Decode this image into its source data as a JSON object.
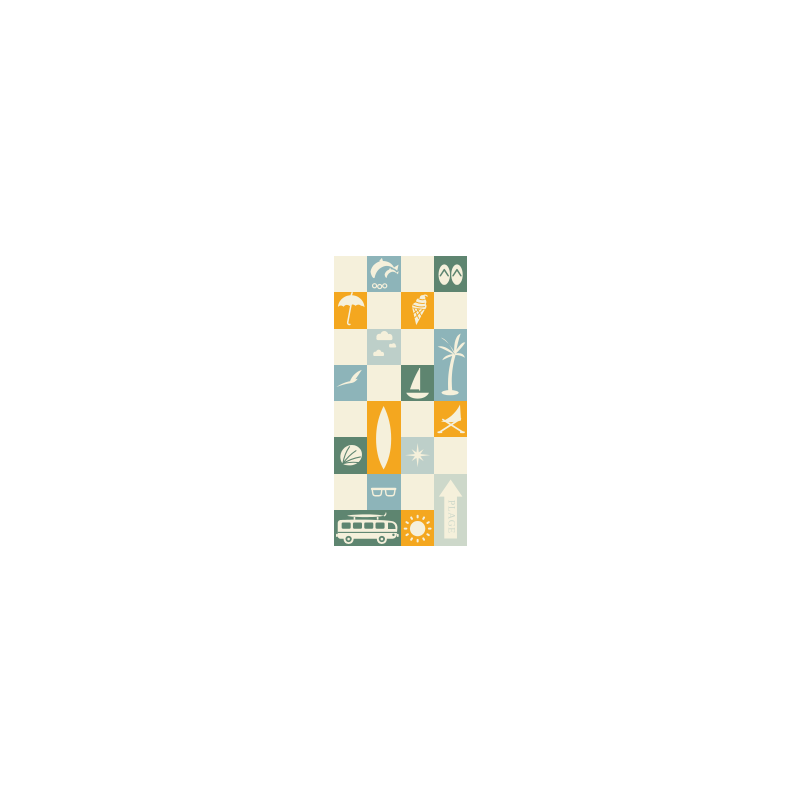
{
  "page": {
    "background": "#ffffff"
  },
  "artwork": {
    "name": "beach-checker-pattern-towel",
    "grid": {
      "columns": 4,
      "rows": 8
    },
    "colors": {
      "cream": "#f5f0db",
      "teal": "#8db4b9",
      "pale_blue": "#bdcfc9",
      "green": "#5e8570",
      "orange": "#f4a71f",
      "pale_sage": "#cdd8ca"
    },
    "plage_sign": {
      "label": "PLAGE"
    },
    "tiles": [
      {
        "name": "tile-empty",
        "row": 1,
        "col": 1,
        "bg": "cream",
        "icon": null
      },
      {
        "name": "tile-dolphins",
        "row": 1,
        "col": 2,
        "bg": "teal",
        "icon": "dolphins"
      },
      {
        "name": "tile-empty",
        "row": 1,
        "col": 3,
        "bg": "cream",
        "icon": null
      },
      {
        "name": "tile-flipflops",
        "row": 1,
        "col": 4,
        "bg": "green",
        "icon": "flipflops"
      },
      {
        "name": "tile-umbrella",
        "row": 2,
        "col": 1,
        "bg": "orange",
        "icon": "umbrella"
      },
      {
        "name": "tile-empty",
        "row": 2,
        "col": 2,
        "bg": "cream",
        "icon": null
      },
      {
        "name": "tile-icecream",
        "row": 2,
        "col": 3,
        "bg": "orange",
        "icon": "icecream"
      },
      {
        "name": "tile-empty",
        "row": 2,
        "col": 4,
        "bg": "cream",
        "icon": null
      },
      {
        "name": "tile-empty",
        "row": 3,
        "col": 1,
        "bg": "cream",
        "icon": null
      },
      {
        "name": "tile-clouds",
        "row": 3,
        "col": 2,
        "bg": "pale_blue",
        "icon": "clouds"
      },
      {
        "name": "tile-empty",
        "row": 3,
        "col": 3,
        "bg": "cream",
        "icon": null
      },
      {
        "name": "tile-palm",
        "row": 3,
        "col": 4,
        "rowspan": 2,
        "bg": "teal",
        "icon": "palm"
      },
      {
        "name": "tile-seagull",
        "row": 4,
        "col": 1,
        "bg": "teal",
        "icon": "seagull"
      },
      {
        "name": "tile-empty",
        "row": 4,
        "col": 2,
        "bg": "cream",
        "icon": null
      },
      {
        "name": "tile-sailboat",
        "row": 4,
        "col": 3,
        "bg": "green",
        "icon": "sailboat"
      },
      {
        "name": "tile-empty",
        "row": 5,
        "col": 1,
        "bg": "cream",
        "icon": null
      },
      {
        "name": "tile-surfboard",
        "row": 5,
        "col": 2,
        "rowspan": 2,
        "bg": "orange",
        "icon": "surfboard"
      },
      {
        "name": "tile-empty",
        "row": 5,
        "col": 3,
        "bg": "cream",
        "icon": null
      },
      {
        "name": "tile-deckchair",
        "row": 5,
        "col": 4,
        "bg": "orange",
        "icon": "deckchair"
      },
      {
        "name": "tile-shell",
        "row": 6,
        "col": 1,
        "bg": "green",
        "icon": "shell"
      },
      {
        "name": "tile-starburst",
        "row": 6,
        "col": 3,
        "bg": "pale_blue",
        "icon": "starburst"
      },
      {
        "name": "tile-empty",
        "row": 6,
        "col": 4,
        "bg": "cream",
        "icon": null
      },
      {
        "name": "tile-empty",
        "row": 7,
        "col": 1,
        "bg": "cream",
        "icon": null
      },
      {
        "name": "tile-sunglasses",
        "row": 7,
        "col": 2,
        "bg": "teal",
        "icon": "sunglasses"
      },
      {
        "name": "tile-empty",
        "row": 7,
        "col": 3,
        "bg": "cream",
        "icon": null
      },
      {
        "name": "tile-plage-sign",
        "row": 7,
        "col": 4,
        "rowspan": 2,
        "bg": "pale_sage",
        "icon": "plage"
      },
      {
        "name": "tile-van",
        "row": 8,
        "col": 1,
        "colspan": 2,
        "bg": "green",
        "icon": "van"
      },
      {
        "name": "tile-sun",
        "row": 8,
        "col": 3,
        "bg": "orange",
        "icon": "sun"
      }
    ]
  }
}
